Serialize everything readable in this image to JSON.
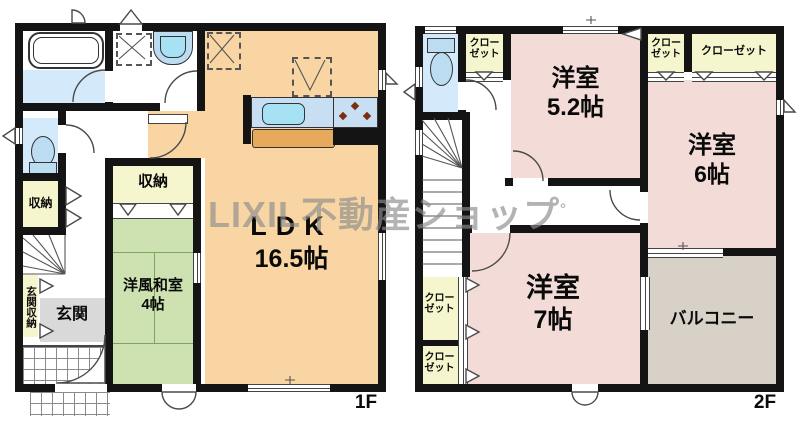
{
  "watermark": {
    "text": "LIXIL不動産ショップ",
    "mark": "°"
  },
  "floor1": {
    "label": "1F",
    "ldk": {
      "name": "LDK",
      "size": "16.5帖"
    },
    "washitsu": {
      "name": "洋風和室",
      "size": "4帖"
    },
    "storage_center": "収納",
    "storage_side": "収納",
    "entrance": "玄関",
    "entrance_storage": "玄関収納"
  },
  "floor2": {
    "label": "2F",
    "bedroom_a": {
      "name": "洋室",
      "size": "5.2帖"
    },
    "bedroom_b": {
      "name": "洋室",
      "size": "6帖"
    },
    "bedroom_c": {
      "name": "洋室",
      "size": "7帖"
    },
    "balcony": "バルコニー",
    "closet_two_line": {
      "line1": "クロー",
      "line2": "ゼット"
    },
    "closet_wide": "クローゼット"
  },
  "colors": {
    "wall": "#141414",
    "ldk_orange": "#f8d5a3",
    "tatami_green": "#cde2b0",
    "bedroom_pink": "#f3dbd7",
    "closet_yellow": "#f6f6ce",
    "water_blue": "#d4e9f9",
    "fixture_blue": "#bcdcf2",
    "sink_cyan": "#a7e1f4",
    "counter_blue": "#c8def2",
    "cabinet_tan": "#e7a95c",
    "entry_gray": "#d9d9d9",
    "balcony_gray": "#d7d1c7",
    "burner_brown": "#7a3010",
    "watermark_gray": "#8d8d8d"
  }
}
